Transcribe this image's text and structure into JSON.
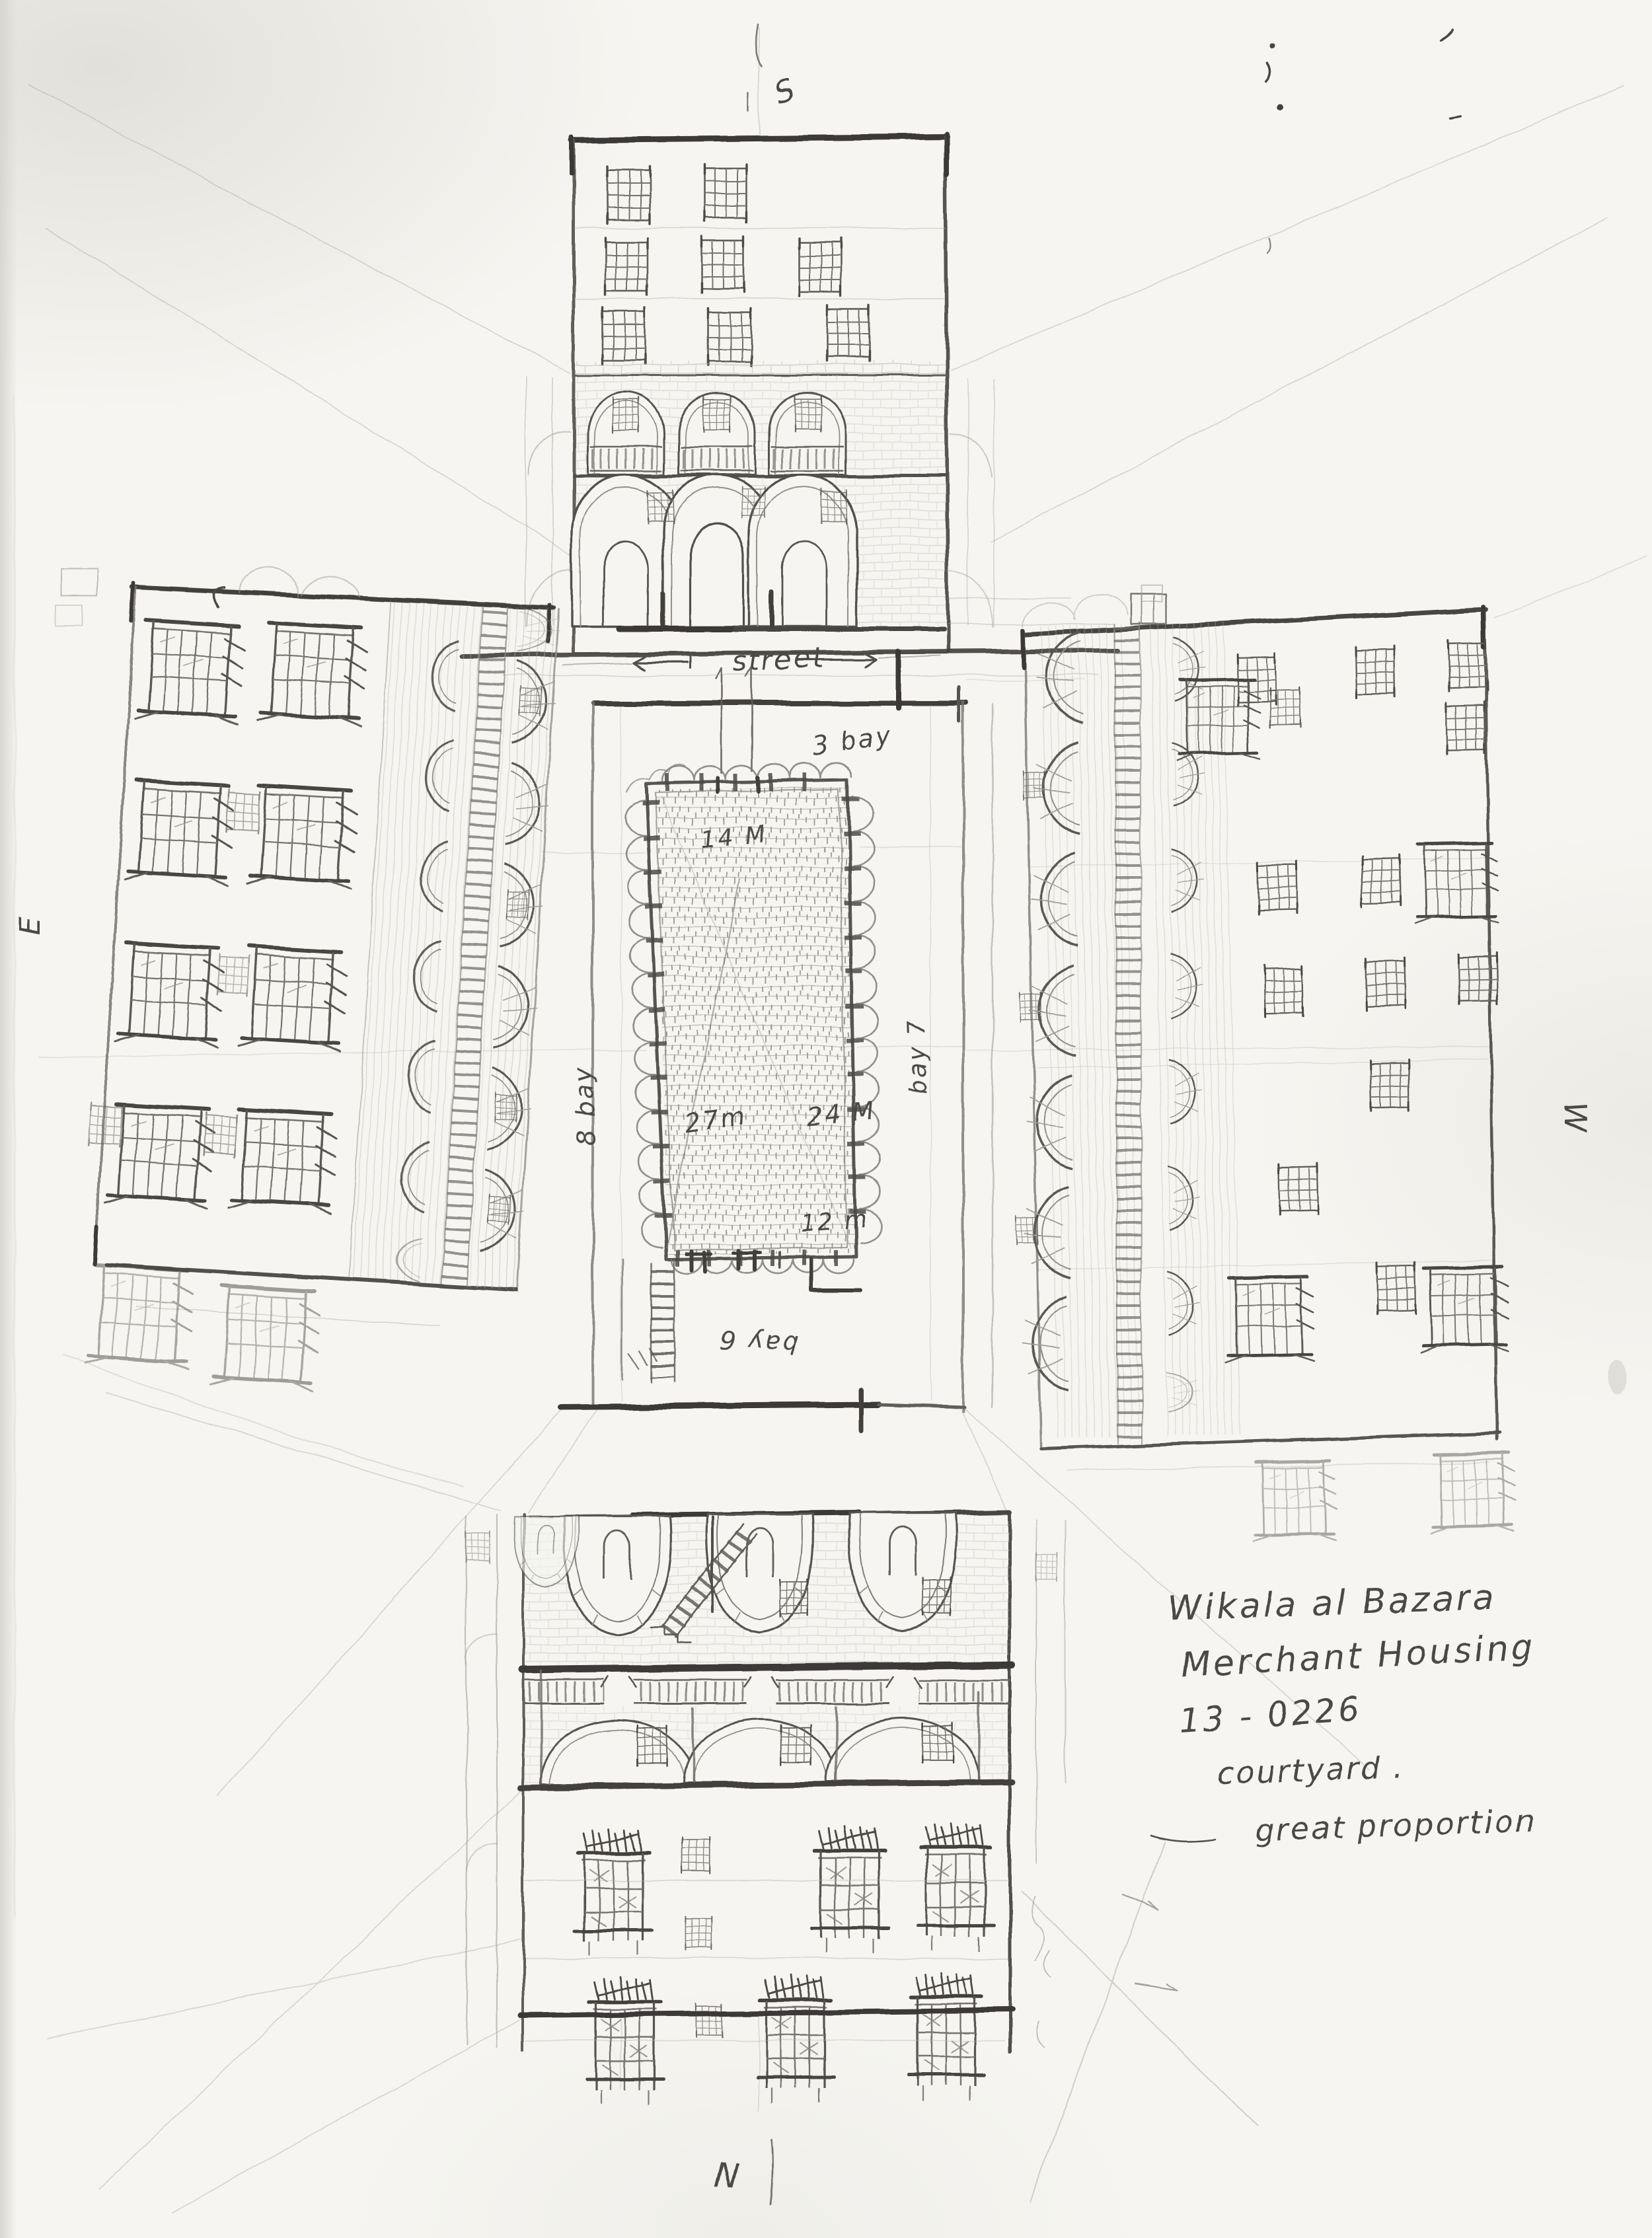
{
  "colors": {
    "paper": "#f6f5f1",
    "graphite_dark": "#2e2c29",
    "graphite": "#4a4844",
    "graphite_light": "#8a8880",
    "graphite_faint": "#b3b0a8"
  },
  "compass": {
    "south": "S",
    "north": "N",
    "east": "E",
    "west": "W"
  },
  "street": {
    "label": "street"
  },
  "courtyard": {
    "top_width": "14 M",
    "left_depth": "27m",
    "right_depth": "24 M",
    "bottom_width": "12 m",
    "top_bays": "3 bay",
    "left_bays": "8 bay",
    "right_bays": "bay 7",
    "bottom_bays": "bay 6"
  },
  "notes": {
    "line1": "Wikala al Bazara",
    "line2": "Merchant Housing",
    "line3": "13 - 0226",
    "line4": "courtyard .",
    "line5": "great proportion"
  }
}
